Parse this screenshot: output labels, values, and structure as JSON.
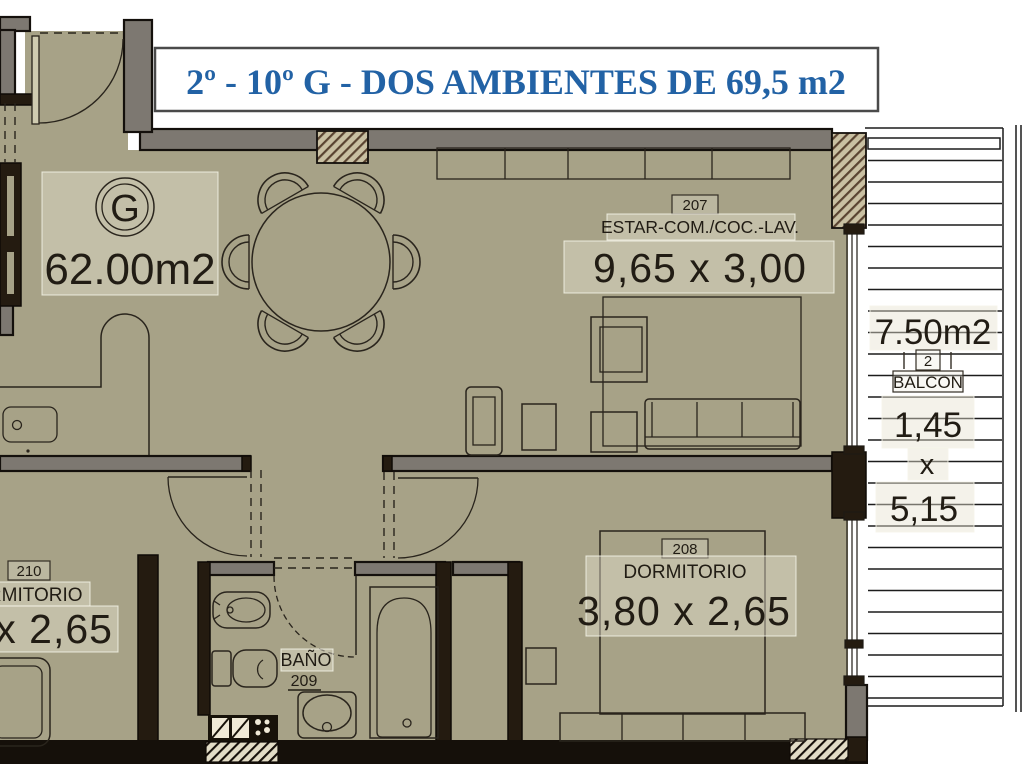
{
  "title": {
    "text": "2º - 10º G - DOS AMBIENTES DE 69,5 m2"
  },
  "unit": {
    "circle_letter": "G",
    "covered_area": "62.00m2"
  },
  "rooms": {
    "living": {
      "number": "207",
      "name": "ESTAR-COM./COC.-LAV.",
      "dims": "9,65 x 3,00"
    },
    "bedroom_main": {
      "number": "208",
      "name": "DORMITORIO",
      "dims": "3,80 x 2,65"
    },
    "bathroom": {
      "number": "209",
      "name": "BAÑO"
    },
    "bedroom_left": {
      "number": "210",
      "name": "DORMITORIO",
      "dims": "3,80 x 2,65"
    }
  },
  "balcony": {
    "area": "7.50m2",
    "number": "2",
    "name": "BALCON",
    "width": "1,45",
    "sep": "x",
    "length": "5,15"
  },
  "colors": {
    "floor": "#a7a287",
    "door_leaf": "#cfcbb0",
    "wall_gray": "#7d7871",
    "wall_dark": "#241b10",
    "title_blue": "#2262a5",
    "line": "#29241c",
    "balcony_line": "#1c1c1c",
    "hatch_brown": "#5a4431"
  }
}
